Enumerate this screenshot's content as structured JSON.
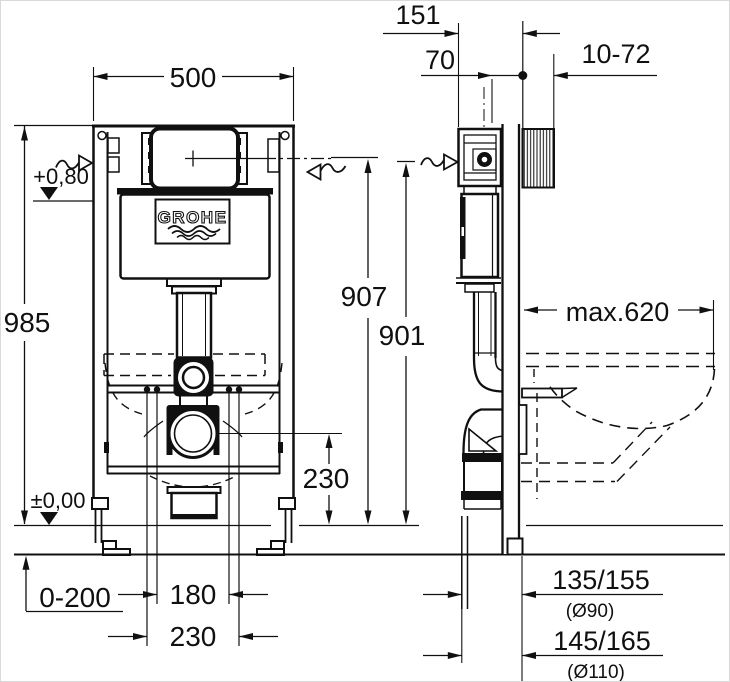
{
  "brand": {
    "logo_text": "GROHE"
  },
  "front_view": {
    "frame_width": "500",
    "frame_height": "985",
    "supply_level": "+0,80",
    "floor_level": "±0,00",
    "outlet_center_height": "230",
    "foot_adjustment_range": "0-200",
    "stud_spacing": "180",
    "fixing_spacing": "230"
  },
  "side_view": {
    "top_depth": "151",
    "supply_offset": "70",
    "wall_thickness_range": "10-72",
    "actuation_height": "907",
    "supply_height": "901",
    "max_projection": "max.620",
    "drain_offset_small": "135/155",
    "drain_dia_small": "(Ø90)",
    "drain_offset_large": "145/165",
    "drain_dia_large": "(Ø110)"
  },
  "colors": {
    "ink": "#101010",
    "paper": "#ffffff"
  }
}
